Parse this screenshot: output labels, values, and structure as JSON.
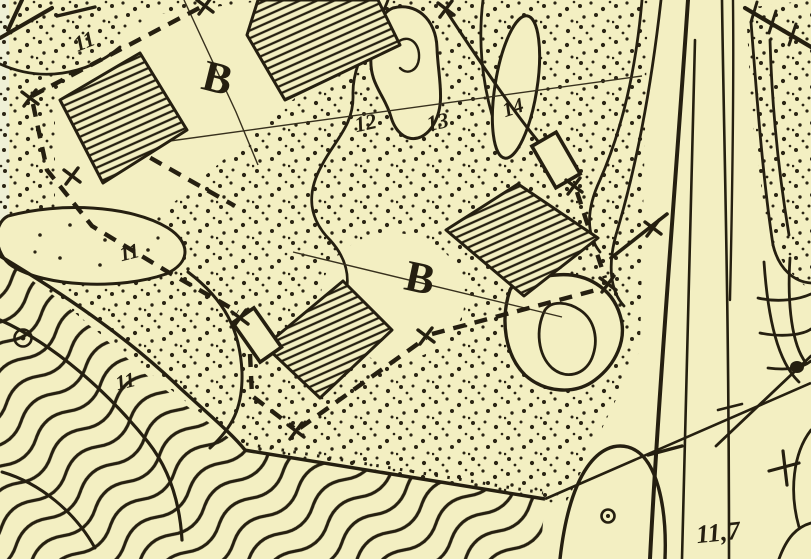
{
  "map": {
    "background_color": "#f3efc2",
    "ink_color": "#251f10",
    "labels": {
      "building_block": "B",
      "number_11": "11",
      "number_12": "12",
      "number_13": "13",
      "number_14": "14",
      "spot_height": "11,7"
    },
    "symbols": {
      "survey_cross": "X boundary mark",
      "monument_circle": "circled survey point",
      "plus_mark": "+"
    },
    "areas": {
      "stipple": "dotted open ground",
      "waves": "wavy hachured slope",
      "hatched_building": "hatched structure",
      "road": "double-line road"
    }
  }
}
